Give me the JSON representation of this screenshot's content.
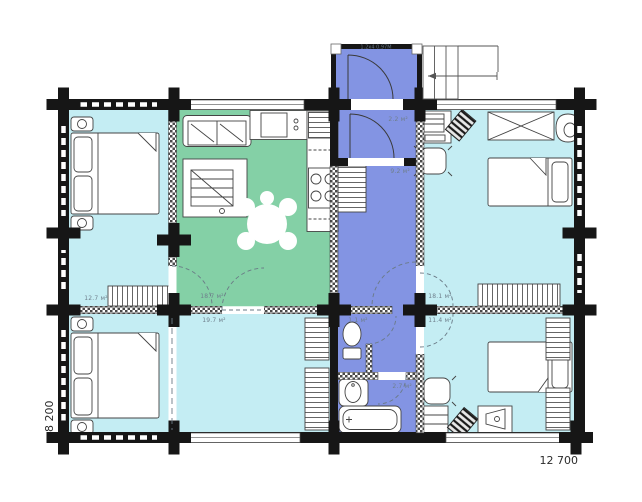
{
  "plan": {
    "type": "log-house floor plan",
    "dims": {
      "width": "12 700",
      "height": "8 200"
    },
    "labels": {
      "vestibule": "1.2x4 0.97M",
      "hall22": "2.2 м²",
      "corridor": "9.2 м²",
      "wc": "1.1 м²",
      "bath": "2.7 м²",
      "bed1": "12.7 м²",
      "living": "18.7 м²",
      "room197": "19.7 м²",
      "bed2": "18.1 м²",
      "bed4": "11.4 м²"
    },
    "colors": {
      "bedroom_cyan": "#c4edf3",
      "living_green": "#84d0a6",
      "hall_blue": "#8394e3",
      "wall_black": "#161616"
    },
    "rooms": [
      {
        "name": "bedroom-top-left",
        "color": "#c4edf3",
        "area_label": "12.7 м²"
      },
      {
        "name": "living-kitchen",
        "color": "#84d0a6",
        "area_label": "18.7 м²"
      },
      {
        "name": "bedroom-bottom-left",
        "color": "#c4edf3",
        "area_label": ""
      },
      {
        "name": "hall-room",
        "color": "#c4edf3",
        "area_label": "19.7 м²"
      },
      {
        "name": "vestibule",
        "color": "#8394e3",
        "area_label": "1.2x4 0.97M"
      },
      {
        "name": "entry-hall",
        "color": "#8394e3",
        "area_label": "2.2 м²"
      },
      {
        "name": "corridor",
        "color": "#8394e3",
        "area_label": "9.2 м²"
      },
      {
        "name": "wc",
        "color": "#8394e3",
        "area_label": "1.1 м²"
      },
      {
        "name": "bathroom",
        "color": "#8394e3",
        "area_label": "2.7 м²"
      },
      {
        "name": "bedroom-top-right",
        "color": "#c4edf3",
        "area_label": "18.1 м²"
      },
      {
        "name": "bedroom-bottom-right",
        "color": "#c4edf3",
        "area_label": "11.4 м²"
      }
    ]
  }
}
